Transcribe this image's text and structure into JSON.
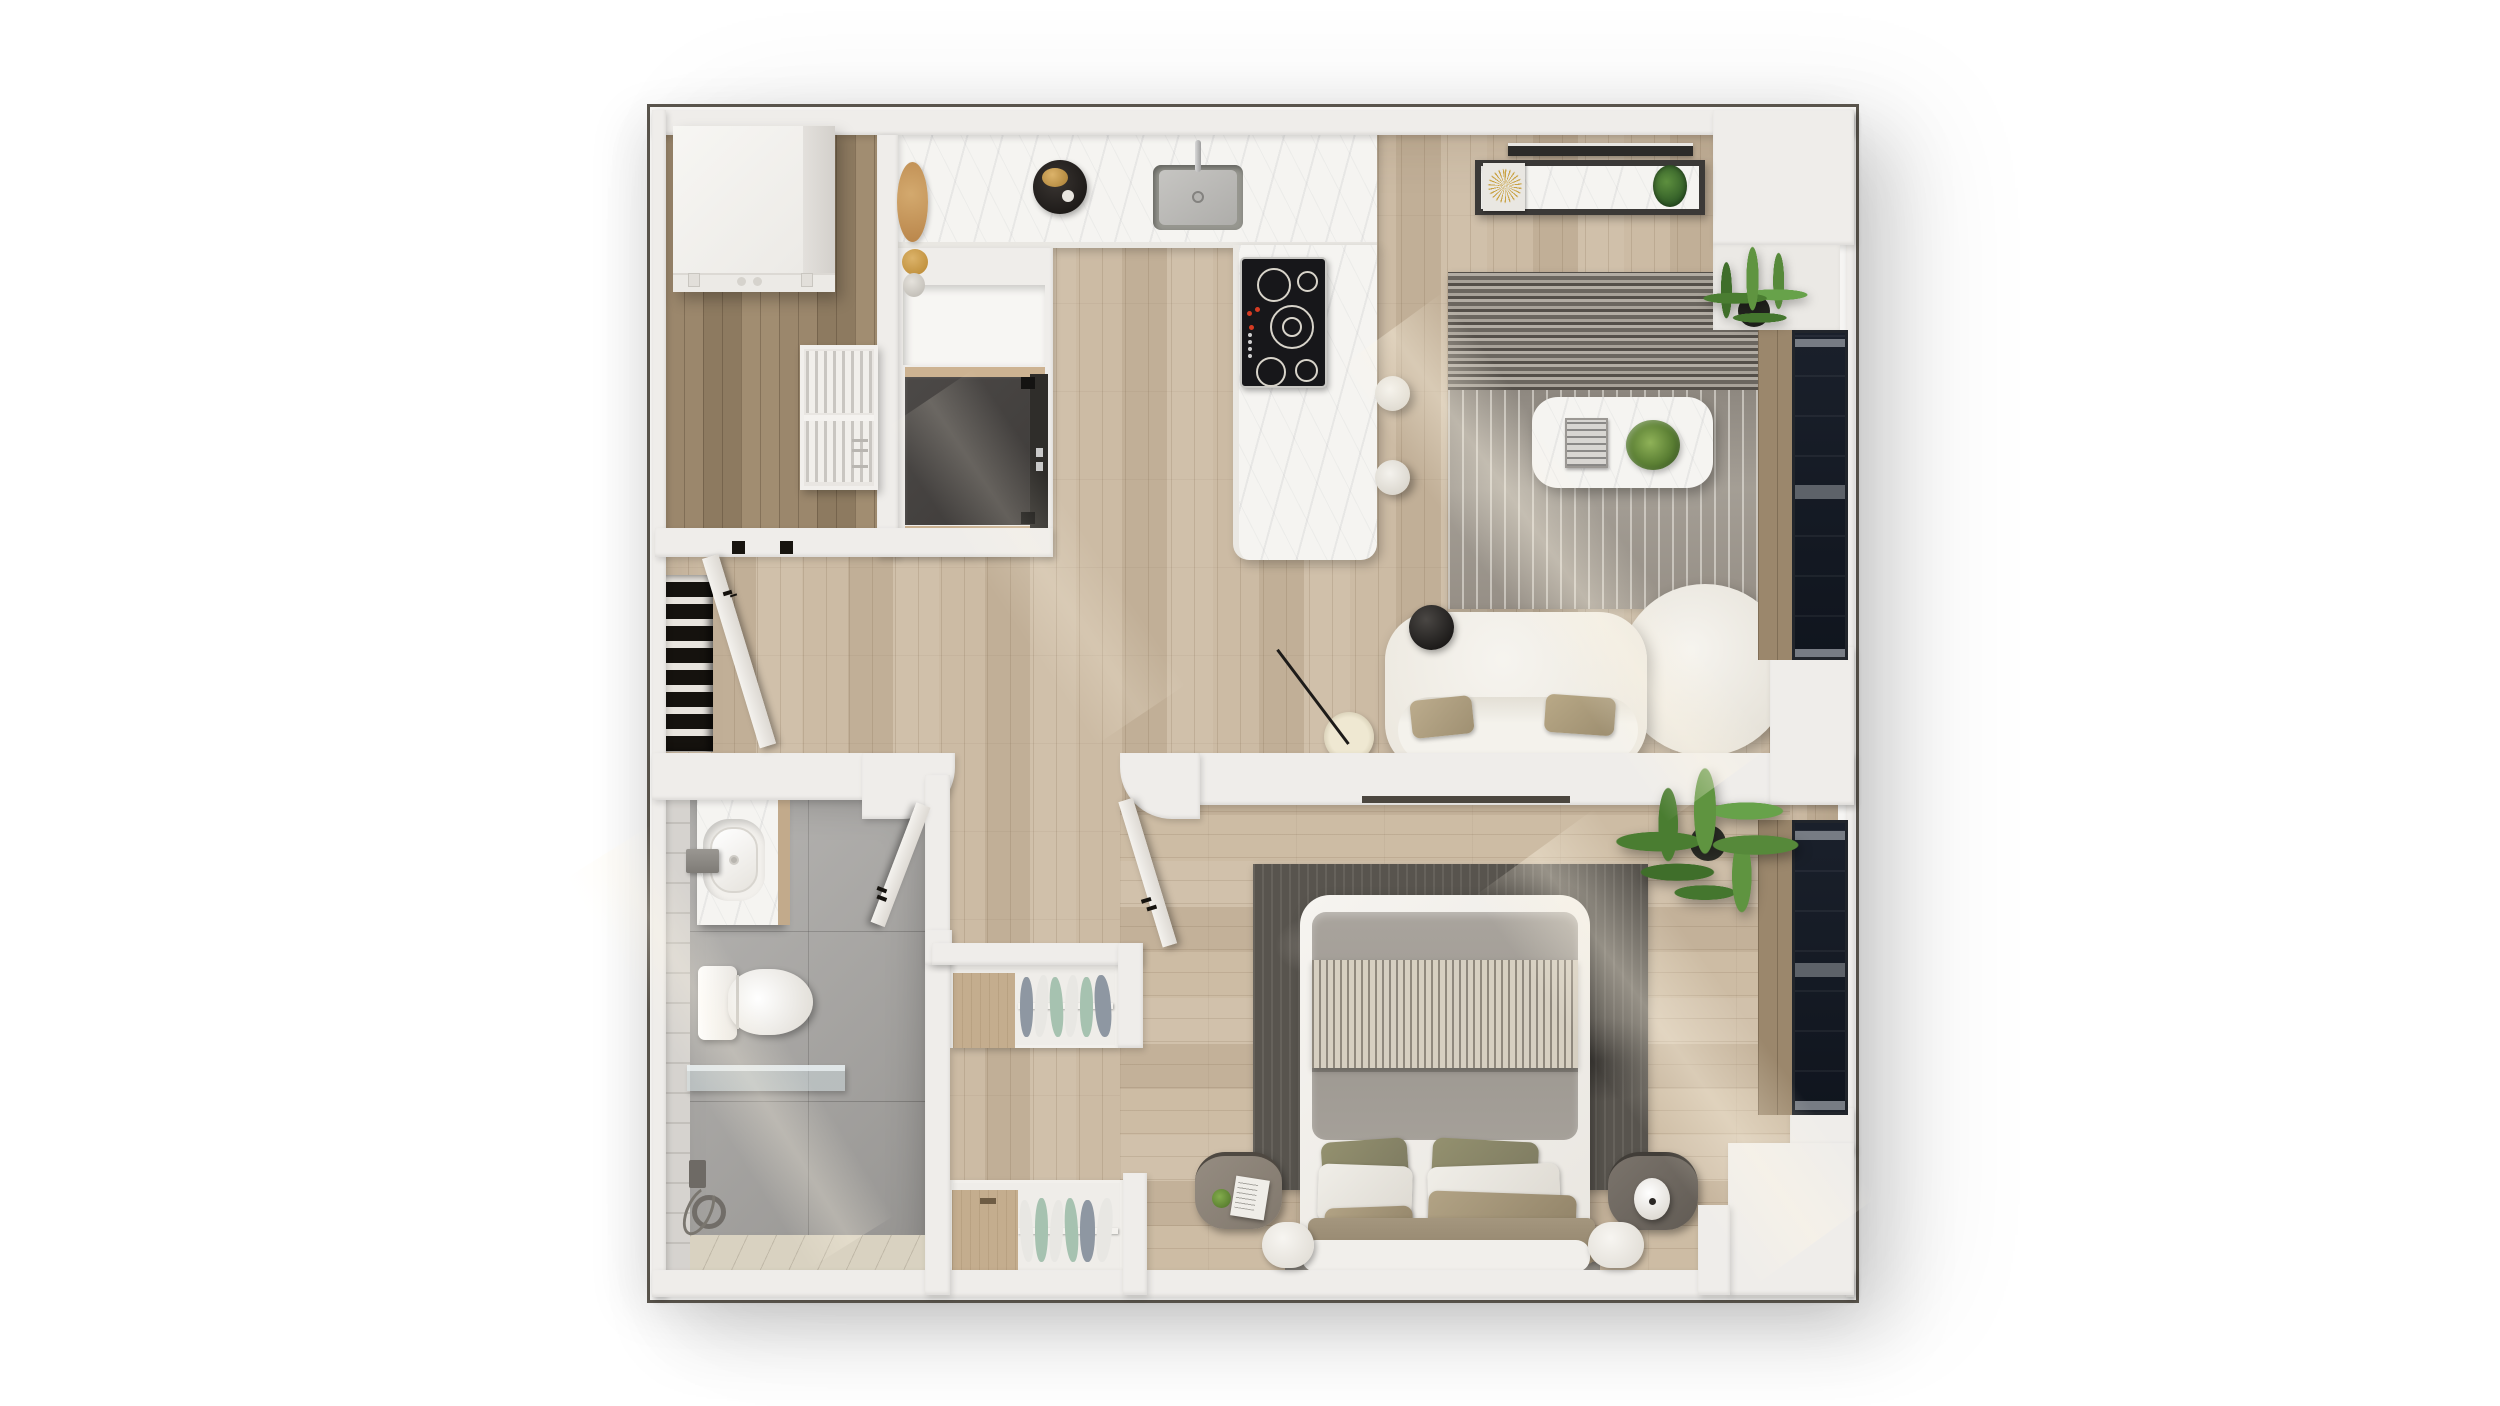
{
  "scene": {
    "kind": "photoreal 3D floor-plan render, top-down view",
    "visible_text": "none",
    "layout": "one-bedroom apartment: kitchen and living room on top, hallway center-left, bathroom bottom-left, walk-in closet bottom-center, bedroom bottom-right"
  },
  "palette": {
    "canvas": "#ffffff",
    "wall": "#efedea",
    "plan_outline": "#59544c",
    "wood_floor": "#c8b7a0",
    "wood_floor_dark": "#97846a",
    "marble": "#f5f4f1",
    "bathroom_tile": "#a7a5a2",
    "living_rug": "#948e85",
    "bedroom_rug": "#57534d",
    "fridge_dark": "#454240",
    "window_frame": "#21252b",
    "sofa_boucle": "#f3f1ec",
    "pillow_tan": "#b0a083",
    "pillow_olive": "#8b886f",
    "plant_green": "#4e7d35",
    "gold_accent": "#c9a242",
    "cooktop_black": "#17171a"
  },
  "rooms": [
    {
      "id": "entry",
      "label": "Entry nook",
      "features": [
        "white storage cabinet",
        "slatted shelf unit",
        "stair void",
        "open entry door"
      ]
    },
    {
      "id": "kitchen",
      "label": "Kitchen",
      "features": [
        "L-shaped marble counter with peninsula island",
        "undermount sink with faucet",
        "5-burner black cooktop",
        "two white bar stools",
        "tall unit with dark built-in fridge",
        "round serving tray with teapot",
        "cutting board",
        "jars"
      ]
    },
    {
      "id": "living",
      "label": "Living room",
      "features": [
        "striped gray rug",
        "white marble coffee table with book and plant",
        "curved white boucle sofa with two tan pillows",
        "black globe floor lamp",
        "media console with gold starburst and plant",
        "wall TV",
        "potted plant in niche",
        "floor-to-ceiling window"
      ]
    },
    {
      "id": "hallway",
      "label": "Hallway",
      "features": [
        "open wood floor"
      ]
    },
    {
      "id": "bathroom",
      "label": "Bathroom",
      "features": [
        "marble vanity with vessel sink",
        "wall-mounted faucet",
        "toilet",
        "glass shower screen",
        "hand shower set",
        "gray tile floor",
        "open door"
      ]
    },
    {
      "id": "closet",
      "label": "Walk-in closet",
      "features": [
        "two open wardrobes with hanging clothes",
        "wooden side cabinets"
      ]
    },
    {
      "id": "bedroom",
      "label": "Bedroom",
      "features": [
        "double bed with gray duvet, striped throw, six pillows",
        "dark distressed rug",
        "two rounded nightstands",
        "white table lamp",
        "book",
        "large palm plant",
        "floor-to-ceiling window",
        "open door"
      ]
    }
  ]
}
